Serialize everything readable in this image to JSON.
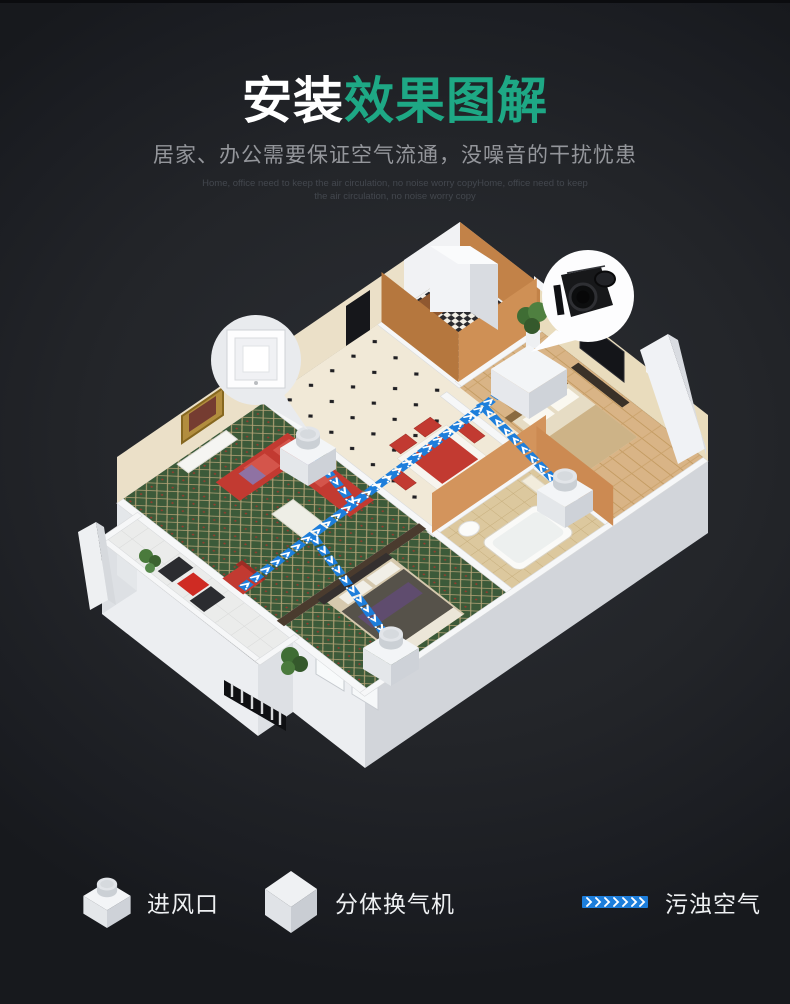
{
  "header": {
    "title_part1": "安装",
    "title_part2": "效果图解",
    "subtitle": "居家、办公需要保证空气流通，没噪音的干扰忧患",
    "subtext_line1": "Home, office need to keep the air circulation, no noise worry copyHome, office need to keep",
    "subtext_line2": "the air circulation, no noise worry copy"
  },
  "colors": {
    "accent_green": "#1ea885",
    "flow_blue": "#1d7edb",
    "background_dark": "#23252a"
  },
  "legend": {
    "items": [
      {
        "icon": "air-inlet-3d-icon",
        "label": "进风口"
      },
      {
        "icon": "split-ventilator-3d-icon",
        "label": "分体换气机"
      },
      {
        "icon": "polluted-air-flow-icon",
        "label": "污浊空气"
      }
    ]
  },
  "diagram": {
    "callouts": [
      {
        "name": "ceiling-vent-panel-callout"
      },
      {
        "name": "ventilator-unit-callout"
      }
    ],
    "markers": {
      "air_inlets": 3,
      "ventilators": 1
    }
  }
}
